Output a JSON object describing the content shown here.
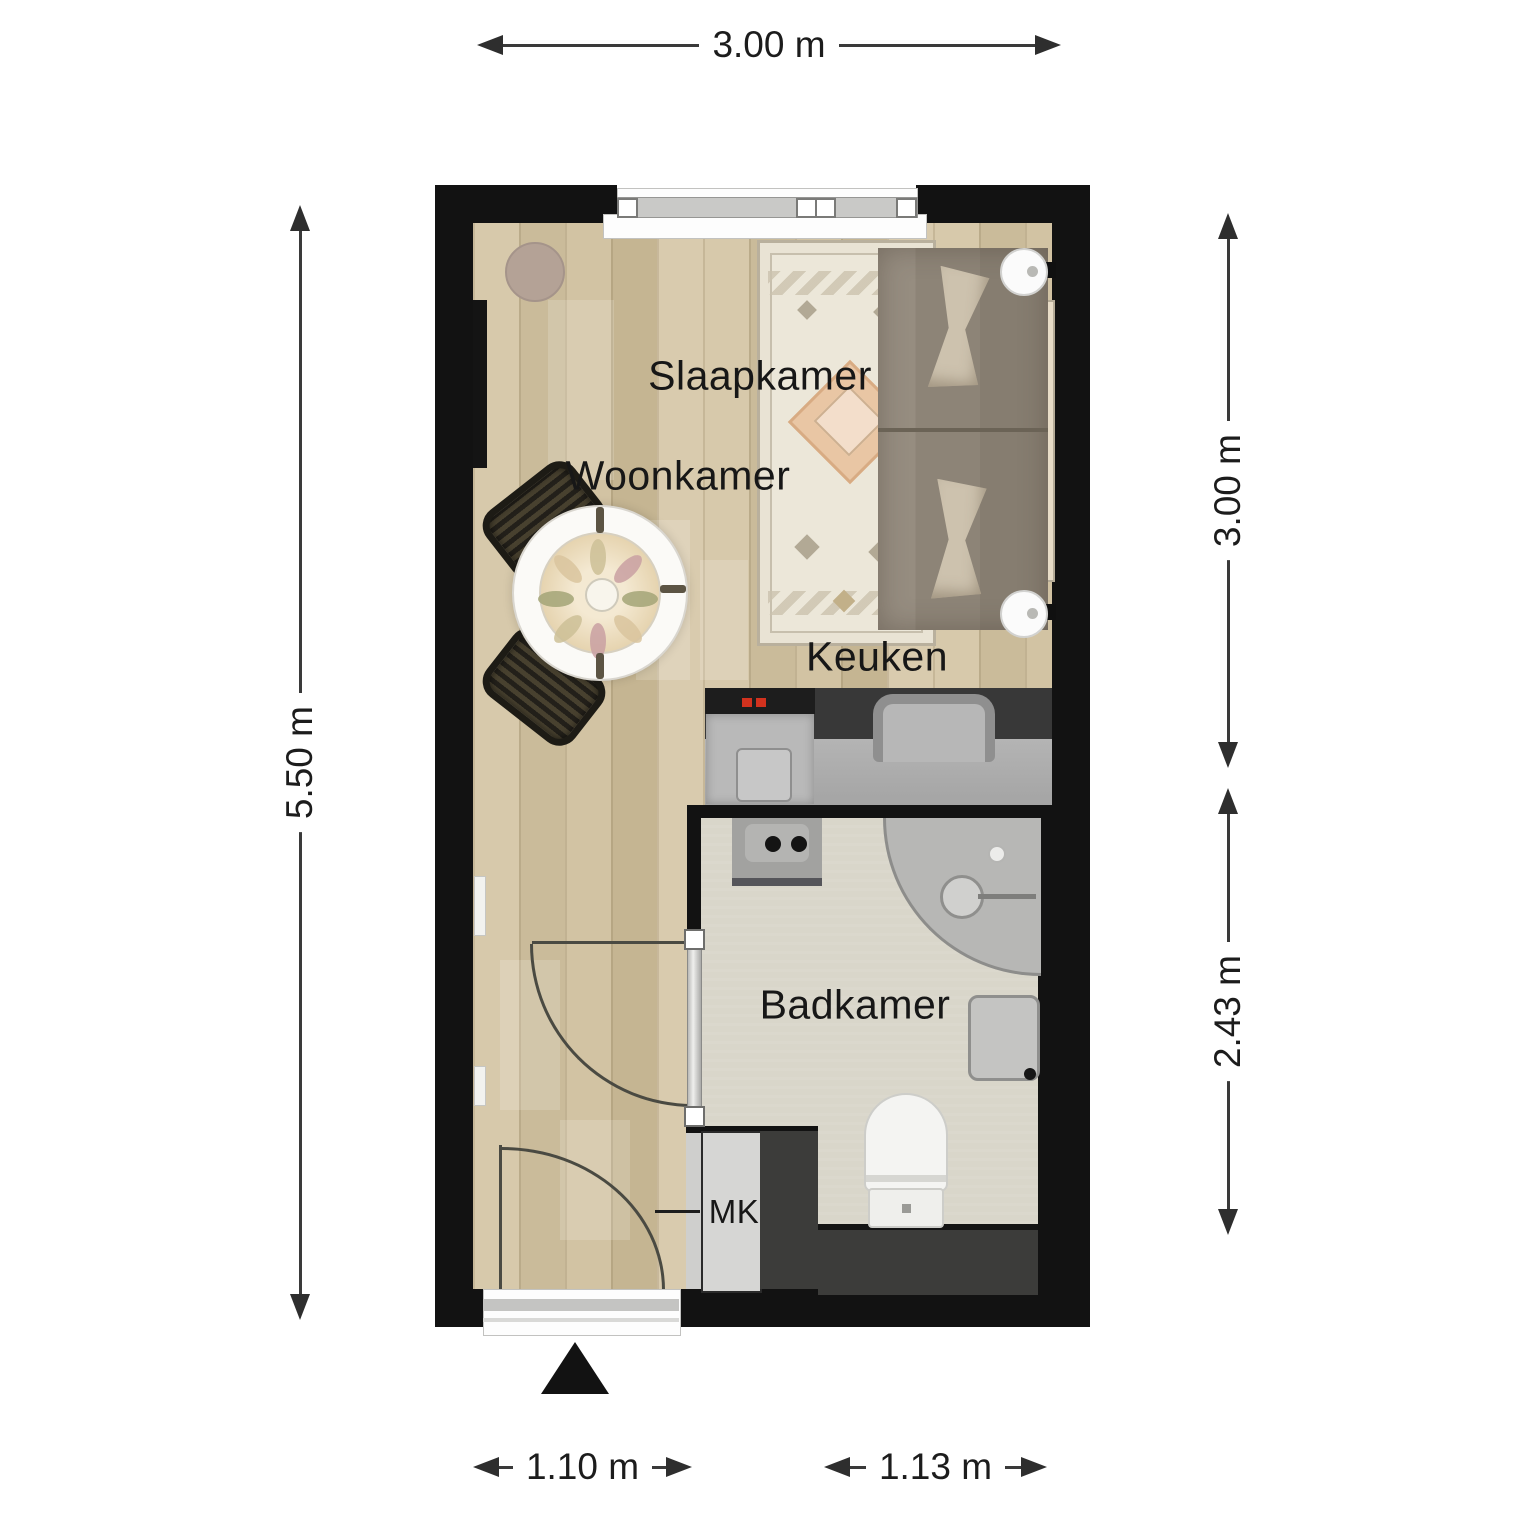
{
  "rooms": {
    "bedroom": "Slaapkamer",
    "living_room": "Woonkamer",
    "kitchen": "Keuken",
    "bathroom": "Badkamer",
    "meter_closet": "MK"
  },
  "dimensions": {
    "top_width": "3.00 m",
    "left_height": "5.50 m",
    "right_upper_height": "3.00 m",
    "right_lower_height": "2.43 m",
    "bottom_left_width": "1.10 m",
    "bottom_right_width": "1.13 m"
  },
  "colors": {
    "wall": "#121212",
    "wood_floor": "#d2c3a4",
    "bathroom_floor": "#d9d6ca",
    "counter_dark": "#383838",
    "counter_top": "#ababab",
    "rug": "#e9e3d4",
    "bed": "#8d8477",
    "stove_knob_red": "#d2321e",
    "dimension_line": "#3a3a3a"
  }
}
